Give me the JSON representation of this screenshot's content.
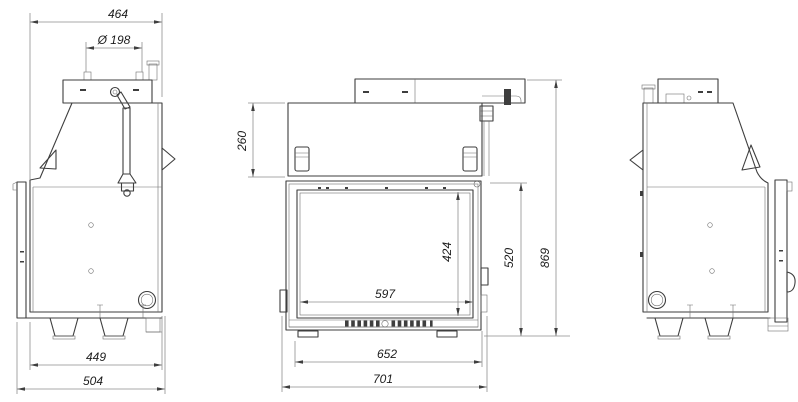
{
  "page": {
    "background": "#ffffff",
    "object_line_color": "#3e3e3e",
    "dimension_line_color": "#8f8f8f",
    "text_color": "#1c1c1c"
  },
  "views": {
    "left_side": {
      "dims": {
        "overall_depth_top": "464",
        "flue_diameter": "Ø 198",
        "body_depth": "449",
        "overall_depth": "504"
      }
    },
    "front": {
      "dims": {
        "hood_height": "260",
        "glass_height": "424",
        "glass_width": "597",
        "firebox_height": "520",
        "overall_height": "869",
        "body_width": "652",
        "overall_width": "701"
      }
    }
  }
}
